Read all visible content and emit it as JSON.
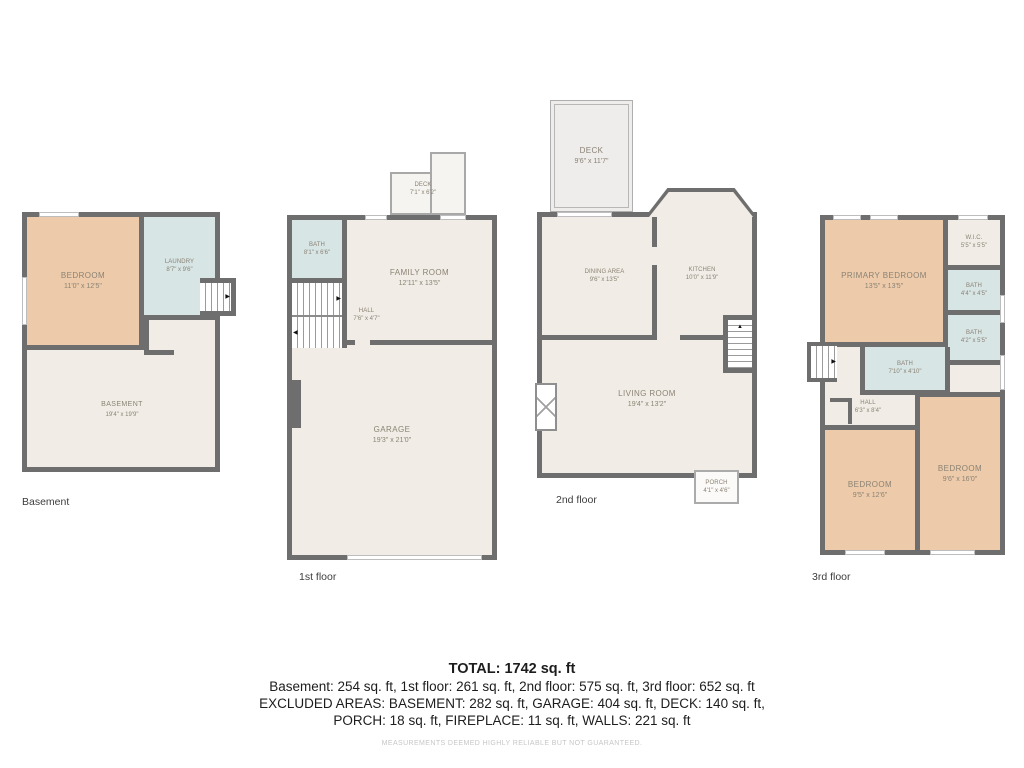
{
  "palette": {
    "wall": "#6e6e6e",
    "bedroom": "#edcbaa",
    "bath": "#d7e5e5",
    "floor": "#f1ede6",
    "deck": "#eeedeb",
    "label": "#8a8274"
  },
  "icons": {
    "stair_arrow_right": "▶",
    "stair_arrow_left": "◀",
    "stair_arrow_up": "▲"
  },
  "floors": [
    {
      "id": "basement",
      "label": "Basement",
      "rooms": [
        {
          "name": "BEDROOM",
          "dims": "11'0\" x 12'5\""
        },
        {
          "name": "LAUNDRY",
          "dims": "8'7\" x 9'6\""
        },
        {
          "name": "BASEMENT",
          "dims": "19'4\" x 19'9\""
        }
      ]
    },
    {
      "id": "first",
      "label": "1st floor",
      "rooms": [
        {
          "name": "DECK",
          "dims": "7'1\" x 6'2\""
        },
        {
          "name": "BATH",
          "dims": "8'1\" x 6'6\""
        },
        {
          "name": "FAMILY ROOM",
          "dims": "12'11\" x 13'5\""
        },
        {
          "name": "HALL",
          "dims": "7'6\" x 4'7\""
        },
        {
          "name": "GARAGE",
          "dims": "19'3\" x 21'0\""
        }
      ]
    },
    {
      "id": "second",
      "label": "2nd floor",
      "rooms": [
        {
          "name": "DECK",
          "dims": "9'6\" x 11'7\""
        },
        {
          "name": "DINING AREA",
          "dims": "9'6\" x 13'5\""
        },
        {
          "name": "KITCHEN",
          "dims": "10'0\" x 11'9\""
        },
        {
          "name": "LIVING ROOM",
          "dims": "19'4\" x 13'2\""
        },
        {
          "name": "PORCH",
          "dims": "4'1\" x 4'6\""
        }
      ]
    },
    {
      "id": "third",
      "label": "3rd floor",
      "rooms": [
        {
          "name": "PRIMARY BEDROOM",
          "dims": "13'5\" x 13'5\""
        },
        {
          "name": "W.I.C.",
          "dims": "5'5\" x 5'5\""
        },
        {
          "name": "BATH",
          "dims": "4'4\" x 4'5\""
        },
        {
          "name": "BATH",
          "dims": "4'2\" x 5'5\""
        },
        {
          "name": "BATH",
          "dims": "7'10\" x 4'10\""
        },
        {
          "name": "HALL",
          "dims": "6'3\" x 8'4\""
        },
        {
          "name": "BEDROOM",
          "dims": "9'6\" x 16'0\""
        },
        {
          "name": "BEDROOM",
          "dims": "9'5\" x 12'6\""
        }
      ]
    }
  ],
  "summary": {
    "total_label": "TOTAL: 1742 sq. ft",
    "floors_line": "Basement: 254 sq. ft, 1st floor: 261 sq. ft, 2nd floor: 575 sq. ft, 3rd floor: 652 sq. ft",
    "excluded_line1": "EXCLUDED AREAS: BASEMENT: 282 sq. ft, GARAGE: 404 sq. ft, DECK: 140 sq. ft,",
    "excluded_line2": "PORCH: 18 sq. ft, FIREPLACE: 11 sq. ft, WALLS: 221 sq. ft",
    "disclaimer": "MEASUREMENTS DEEMED HIGHLY RELIABLE BUT NOT GUARANTEED."
  }
}
